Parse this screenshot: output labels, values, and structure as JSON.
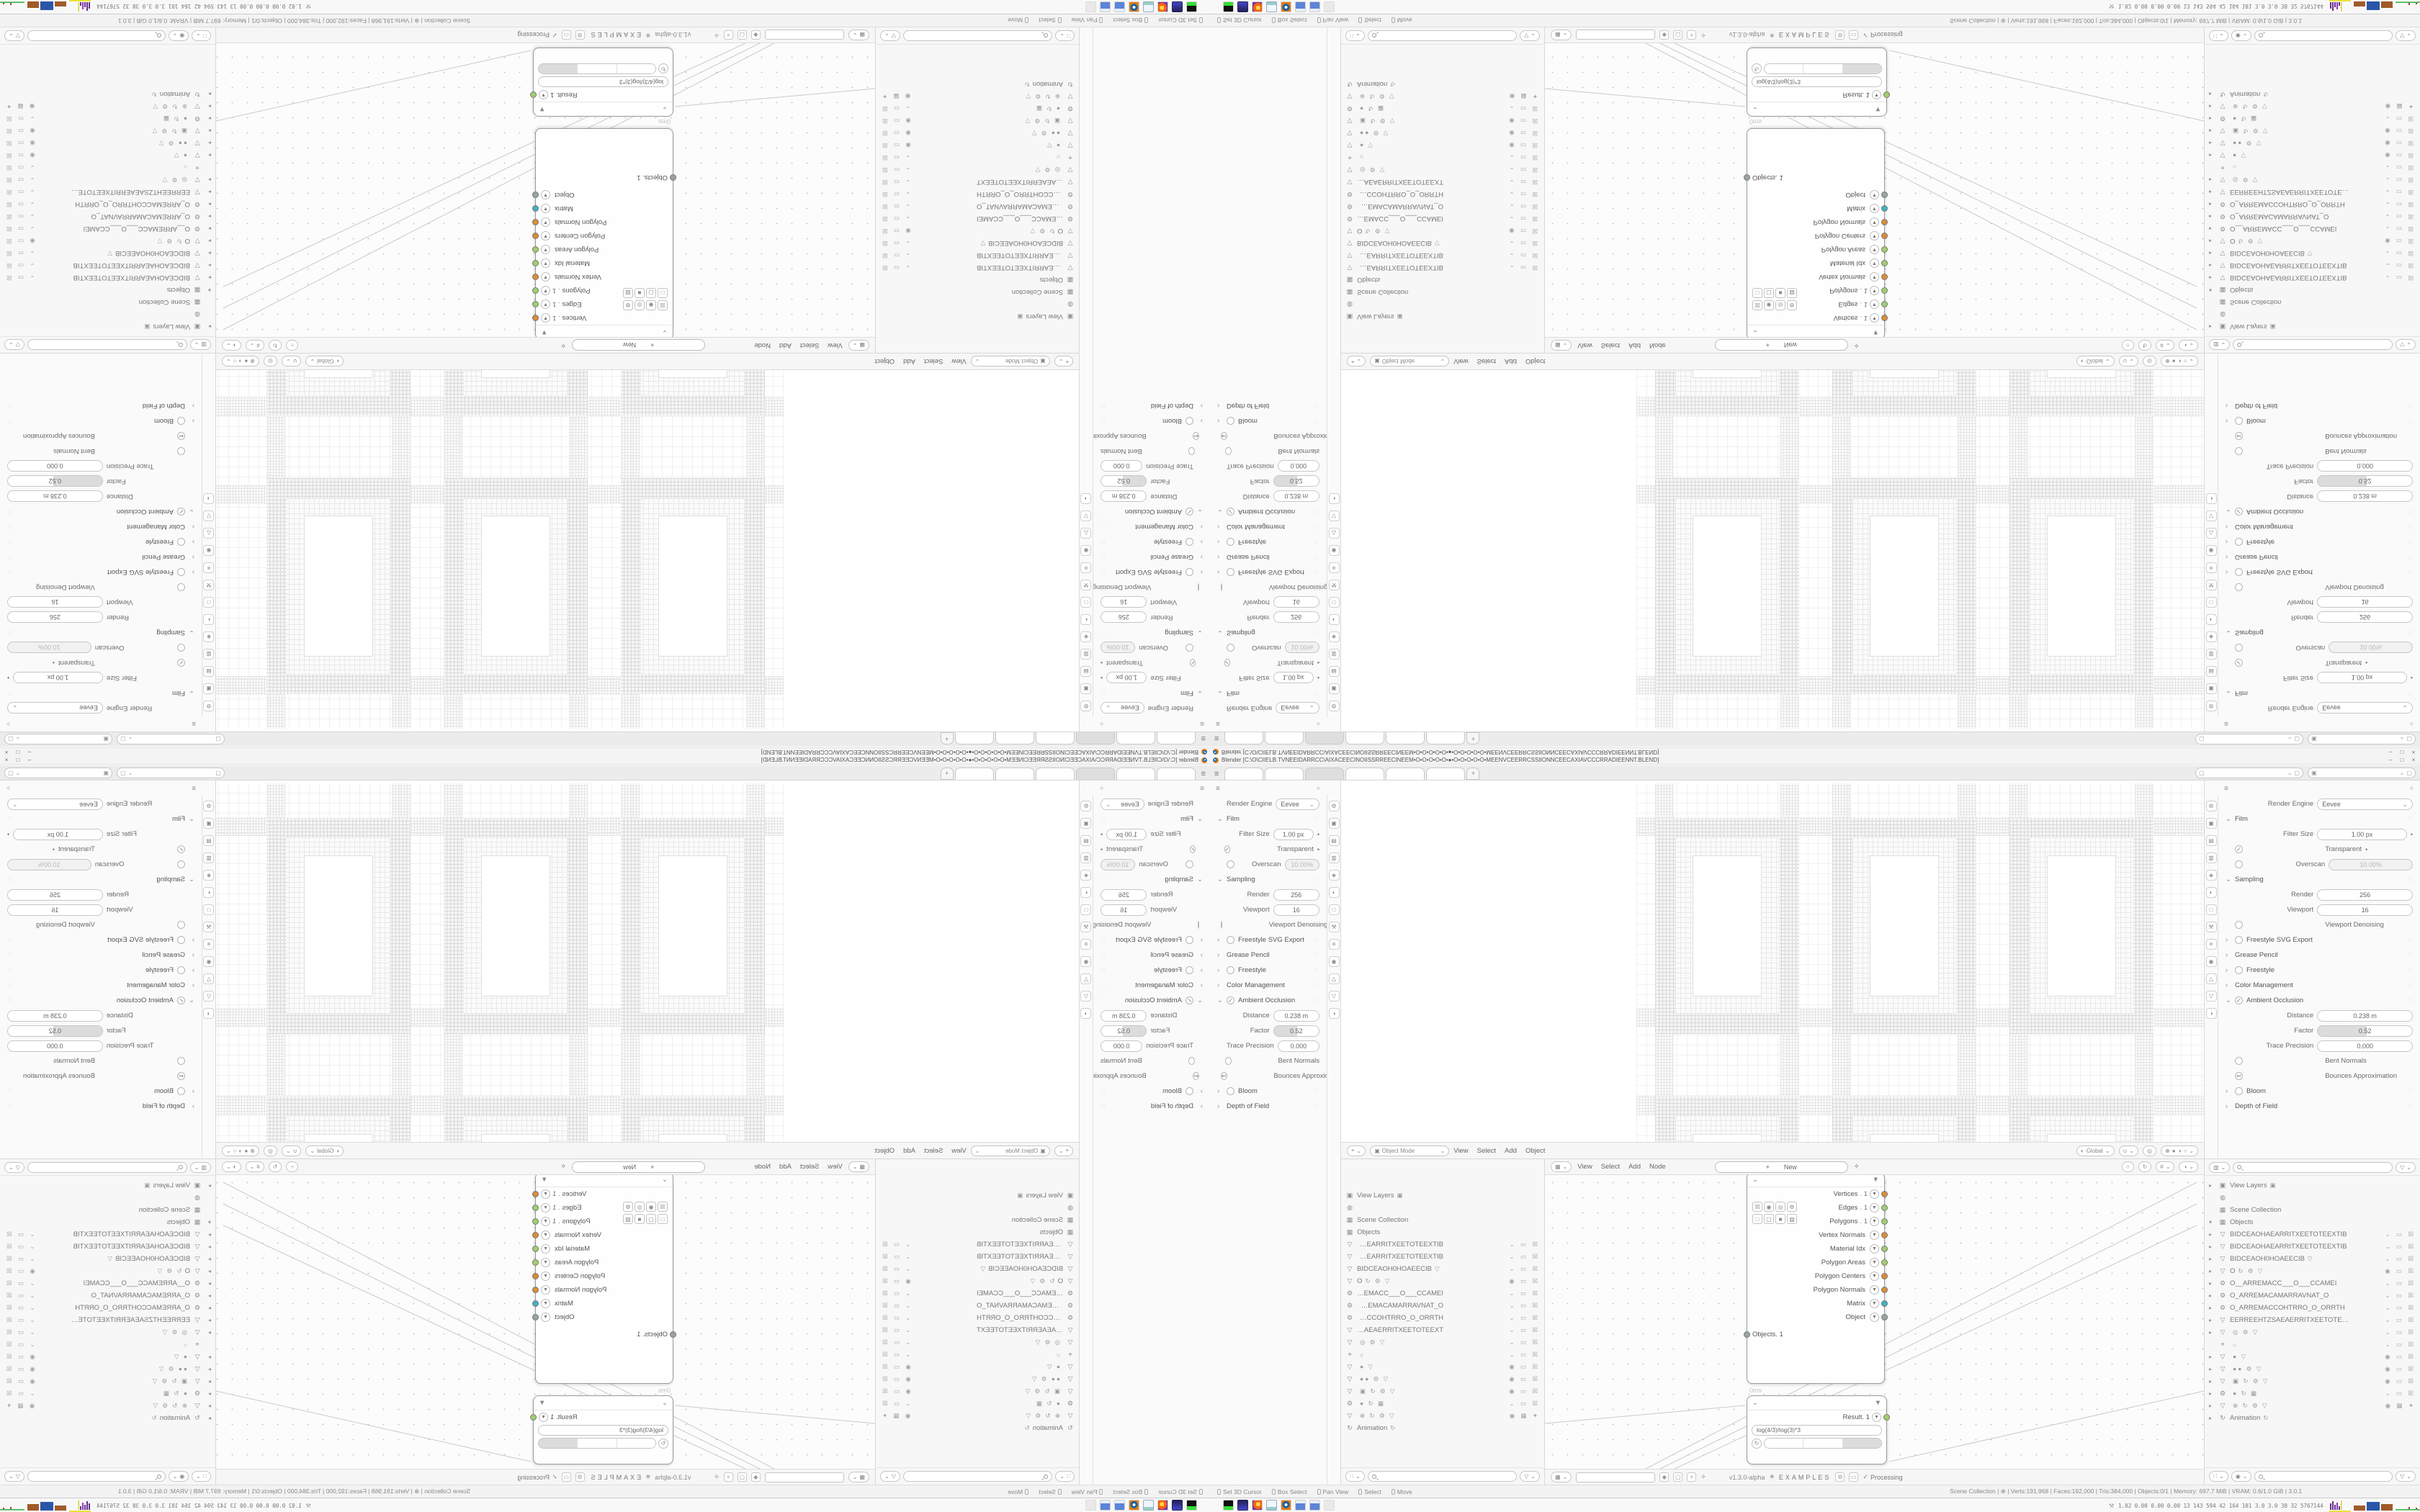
{
  "desktop": {
    "titlebar": {
      "title": "Blender [C:\\O\\CIIELB.TVNEEIDARRCC\\AIXACEECINOIISSRREECINEEM•O•O•O•O•O•●•O•O•O•O•O•MEENVCEERRCSSIIONNCEECAXIAVCCCRRADIEENNT.BLEND]",
      "min": "–",
      "max": "□",
      "close": "×"
    },
    "topbar": {
      "menu_icon": "≡",
      "tabs": [
        {
          "label": ""
        },
        {
          "label": ""
        },
        {
          "label": "",
          "active": true
        },
        {
          "label": ""
        },
        {
          "label": ""
        },
        {
          "label": ""
        }
      ],
      "new_tab": "+",
      "scene_selector": {
        "icon": "▢",
        "value": "",
        "chev": "⌄",
        "extra": "▢"
      },
      "viewlayer_selector": {
        "icon": "▣",
        "value": "",
        "chev": "⌄",
        "extra": "▢"
      }
    },
    "props": {
      "header_icon": "≡",
      "pin_icon": "✧",
      "tabs": [
        "⚙",
        "▣",
        "▤",
        "▥",
        "◈",
        "◐",
        "□",
        "⚒",
        "✳",
        "◉",
        "△",
        "▽",
        "◑"
      ],
      "rows": [
        {
          "t": "select",
          "lab": "Render Engine",
          "val": "Eevee"
        },
        {
          "t": "sec",
          "caret": "⌄",
          "lab": "Film",
          "grip": true
        },
        {
          "t": "field",
          "lab": "Filter Size",
          "val": "1.00 px",
          "dot": true
        },
        {
          "t": "check",
          "chk": "on",
          "lab": "Transparent",
          "dot": true
        },
        {
          "t": "field",
          "chk": "off",
          "lab": "Overscan",
          "val": "10.00%",
          "dis": true
        },
        {
          "t": "sec",
          "caret": "⌄",
          "lab": "Sampling",
          "grip": true
        },
        {
          "t": "field",
          "lab": "Render",
          "val": "256"
        },
        {
          "t": "field",
          "lab": "Viewport",
          "val": "16"
        },
        {
          "t": "check",
          "chk": "off",
          "lab": "Viewport Denoising"
        },
        {
          "t": "sec",
          "caret": "›",
          "chk": "off",
          "lab": "Freestyle SVG Export",
          "grip": true
        },
        {
          "t": "sec",
          "caret": "›",
          "lab": "Grease Pencil",
          "grip": true
        },
        {
          "t": "sec",
          "caret": "›",
          "chk": "off",
          "lab": "Freestyle",
          "grip": true
        },
        {
          "t": "sec",
          "caret": "›",
          "lab": "Color Management",
          "grip": true
        },
        {
          "t": "sec",
          "caret": "⌄",
          "chk": "on",
          "lab": "Ambient Occlusion",
          "grip": true
        },
        {
          "t": "field",
          "lab": "Distance",
          "val": "0.238 m"
        },
        {
          "t": "field",
          "lab": "Factor",
          "val": "0.52",
          "slider": true
        },
        {
          "t": "field",
          "lab": "Trace Precision",
          "val": "0.000"
        },
        {
          "t": "check",
          "chk": "off",
          "lab": "Bent Normals"
        },
        {
          "t": "check",
          "chk": "back",
          "lab": "Bounces Approximation"
        },
        {
          "t": "sec",
          "caret": "›",
          "chk": "off",
          "lab": "Bloom",
          "grip": true
        },
        {
          "t": "sec",
          "caret": "›",
          "lab": "Depth of Field",
          "grip": true
        }
      ]
    },
    "viewport": {
      "mode": "Object Mode",
      "menus": [
        "View",
        "Select",
        "Add",
        "Object"
      ],
      "orientation": "Global"
    },
    "outliner": {
      "rows": [
        {
          "c": "▸",
          "i": "▣",
          "lab": "View Layers",
          "mini": "▣"
        },
        {
          "i": "◍",
          "lab": ""
        },
        {
          "i": "▦",
          "lab": "Scene Collection"
        },
        {
          "c": "▾",
          "i": "▦",
          "lab": "Objects"
        },
        {
          "c": "▸",
          "i": "▽",
          "lab": "BIDCEAOHAEARRITXEETOTEEXTIB",
          "tr": "⌄ ▭ ☒"
        },
        {
          "c": "▸",
          "i": "▽",
          "lab": "BIDCEAOHAEARRITXEETOTEEXTIB",
          "tr": "⌄ ▭ ☒"
        },
        {
          "c": "▸",
          "i": "▽",
          "lab": "BIDCEAOH0HOAEECIB",
          "mini": "▽",
          "tr": "⌄ ▭ ☒"
        },
        {
          "c": "▸",
          "i": "▽",
          "lab": "O",
          "mini": "↻ ⚙ ▽",
          "tr": "◉ ▭ ☒"
        },
        {
          "c": "▸",
          "i": "⚙",
          "lab": "O__ARREMACC___O___CCAMEI",
          "tr": "⌄ ▭ ☒"
        },
        {
          "c": "▸",
          "i": "⚙",
          "lab": "O_ARREMACAMARRAVNAT_O",
          "tr": "⌄ ▭ ☒"
        },
        {
          "c": "▸",
          "i": "⚙",
          "lab": "O_ARREMACCOHTRRO_O_ORRTH",
          "tr": "⌄ ▭ ☒"
        },
        {
          "c": "▸",
          "i": "▽",
          "lab": "EERREEHTZSAEAERRITXEETOTEEXT",
          "tr": "⌄ ▭ ☒"
        },
        {
          "c": "▸",
          "i": "▽",
          "lab": "",
          "mini": "◎ ⚙ ▽",
          "tr": "⌄ ▭ ☒"
        },
        {
          "c": "",
          "i": "⌖",
          "lab": "",
          "mini": "○",
          "tr": "⌄ ▭ ☒"
        },
        {
          "c": "▸",
          "i": "▽",
          "lab": "",
          "mini": "● ▽",
          "tr": "◉ ▭ ☒"
        },
        {
          "c": "▸",
          "i": "▽",
          "lab": "",
          "mini": "●● ⚙ ▽",
          "tr": "◉ ▭ ☒"
        },
        {
          "c": "▸",
          "i": "▽",
          "lab": "",
          "mini": "▣ ↻ ⚙ ▽",
          "tr": "◉ ▭ ☒"
        },
        {
          "c": "▸",
          "i": "⚙",
          "lab": "",
          "mini": "● ↻ ▦",
          "tr": "⌄ ▭ ☒"
        },
        {
          "c": "▸",
          "i": "▽",
          "lab": "",
          "mini": "⊕ ↻ ⚙ ▽",
          "tr": "◉ ▦ ✦"
        },
        {
          "c": "▸",
          "i": "↻",
          "lab": "Animation",
          "mini": "↻"
        }
      ]
    },
    "node_editor": {
      "menus": [
        "View",
        "Select",
        "Add",
        "Node"
      ],
      "new_label": "New",
      "new_plus": "+",
      "version": "v1.3.0-alpha",
      "examples": "EXAMPLES",
      "processing_check": "✓",
      "processing": "Processing",
      "time_label": "0ms",
      "objects_node": {
        "title": "Objects. 1",
        "collapse": "⌄",
        "funnel": "▼",
        "icon_row1": [
          "☒",
          "◉",
          "◎",
          "⚙"
        ],
        "icon_row2": [
          "□",
          "▢",
          "■",
          "▨"
        ],
        "buttons": [
          {
            "label": "Apply matrix"
          },
          {
            "label": "merge"
          },
          {
            "label": "Post"
          },
          {
            "label": "VeGr"
          }
        ],
        "outputs": [
          {
            "lab": "Vertices",
            "sufx": ". 1",
            "color": "#d98d3a"
          },
          {
            "lab": "Edges",
            "sufx": ". 1",
            "color": "#9ed06c"
          },
          {
            "lab": "Polygons",
            "sufx": ". 1",
            "color": "#9ed06c"
          },
          {
            "lab": "Vertex Normals",
            "sufx": "",
            "color": "#d98d3a"
          },
          {
            "lab": "Material Idx",
            "sufx": "",
            "color": "#9ed06c"
          },
          {
            "lab": "Polygon Areas",
            "sufx": "",
            "color": "#9ed06c"
          },
          {
            "lab": "Polygon Centers",
            "sufx": "",
            "color": "#d98d3a"
          },
          {
            "lab": "Polygon Normals",
            "sufx": "",
            "color": "#d98d3a"
          },
          {
            "lab": "Matrix",
            "sufx": "",
            "color": "#3eb3c4"
          },
          {
            "lab": "Object",
            "sufx": "",
            "color": "#9aa4a8"
          }
        ]
      },
      "result_node": {
        "collapse": "⌄",
        "funnel": "▼",
        "out_label": "Result. 1",
        "out_color": "#9ed06c",
        "formula": "log(4/3)/log(3)*3",
        "buttons": [
          {
            "label": "-1"
          },
          {
            "label": "0"
          },
          {
            "label": "+1",
            "active": true
          }
        ]
      }
    },
    "statusbar": {
      "hints": [
        {
          "label": "Set 3D Cursor"
        },
        {
          "label": "Box Select"
        },
        {
          "label": "Pan View"
        },
        {
          "label": "Select"
        },
        {
          "label": "Move"
        }
      ],
      "stats": "Scene Collection | ⊕ | Verts:191,968 | Faces:192,000 | Tris:384,000 | Objects:0/1 | Memory: 697.7 MiB | VRAM: 0.6/1.0 GiB | 3.0.1"
    },
    "taskbar": {
      "icons": [
        {
          "name": "terminal-icon",
          "k": "term"
        },
        {
          "name": "floppy-64-icon",
          "k": "floppy"
        },
        {
          "name": "firefox-icon",
          "k": "firefox"
        },
        {
          "name": "notepad-icon",
          "k": "notepad"
        },
        {
          "name": "blender-icon",
          "k": "blender"
        },
        {
          "name": "calculator-icon",
          "k": "calc"
        },
        {
          "name": "calculator-icon",
          "k": "calc"
        },
        {
          "name": "ghost-icon",
          "k": "ghost"
        }
      ],
      "tray_text": "1.02 0.00 0.00 0.00  13  143  594  42  164  101  3.0  3.0  38  32  5767144"
    }
  }
}
